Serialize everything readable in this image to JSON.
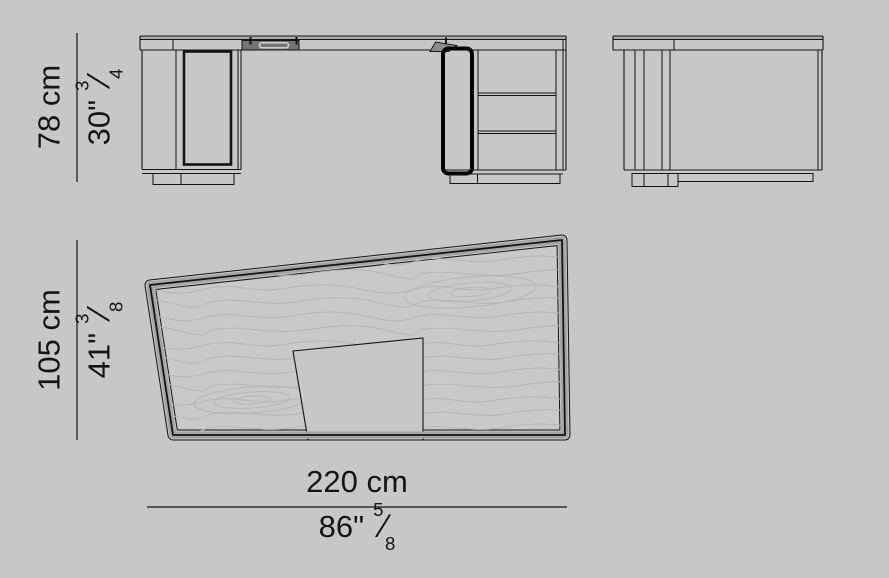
{
  "title": "desk-dimension-diagram",
  "colors": {
    "background": "#c7c7c7",
    "interior": "#c9c9c9",
    "line": "#141414",
    "grain": "#b5b5b5",
    "band_gray": "#a4a4a4",
    "slab_band": "#ababab",
    "tray_dark": "#757575",
    "wedge_gray": "#8b8b8b",
    "pill_light": "#d9d9d9",
    "highlight": "#000000",
    "text": "#141414"
  },
  "views": {
    "front": "front-elevation",
    "side": "side-elevation",
    "plan": "top-plan"
  },
  "dimensions": {
    "height": {
      "cm": "78 cm",
      "inches": "30\"",
      "frac": {
        "num": "3",
        "slash": "⁄",
        "den": "4"
      }
    },
    "depth": {
      "cm": "105 cm",
      "inches": "41\"",
      "frac": {
        "num": "3",
        "slash": "⁄",
        "den": "8"
      }
    },
    "width": {
      "cm": "220 cm",
      "inches": "86\"",
      "frac": {
        "num": "5",
        "slash": "⁄",
        "den": "8"
      }
    }
  }
}
